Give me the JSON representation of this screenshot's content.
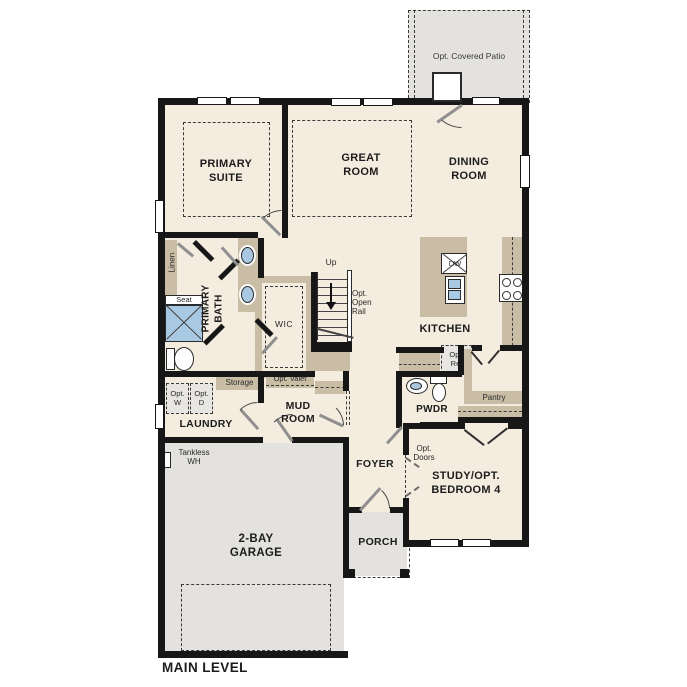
{
  "title": {
    "label": "MAIN LEVEL"
  },
  "rooms": {
    "patio": {
      "label": "Opt. Covered Patio"
    },
    "primary_suite": {
      "label": "PRIMARY\nSUITE"
    },
    "great_room": {
      "label": "GREAT\nROOM"
    },
    "dining_room": {
      "label": "DINING\nROOM"
    },
    "kitchen": {
      "label": "KITCHEN"
    },
    "primary_bath": {
      "label": "PRIMARY\nBATH"
    },
    "wic": {
      "label": "WIC"
    },
    "laundry": {
      "label": "LAUNDRY"
    },
    "mud_room": {
      "label": "MUD\nROOM"
    },
    "pwdr": {
      "label": "PWDR"
    },
    "pantry": {
      "label": "Pantry"
    },
    "foyer": {
      "label": "FOYER"
    },
    "study": {
      "label": "STUDY/OPT.\nBEDROOM 4"
    },
    "garage": {
      "label": "2-BAY\nGARAGE"
    },
    "porch": {
      "label": "PORCH"
    }
  },
  "features": {
    "linen": "Linen",
    "seat": "Seat",
    "storage": "Storage",
    "opt_valet": "Opt. Valet",
    "opt_washer": "Opt.\nW",
    "opt_dryer": "Opt.\nD",
    "opt_ref": "Opt.\nRef",
    "dishwasher": "DW",
    "stairs_up": "Up",
    "opt_open_rail": "Opt.\nOpen\nRail",
    "opt_doors": "Opt.\nDoors",
    "tankless_wh": "Tankless\nWH"
  },
  "colors": {
    "floor": "#f4ecdf",
    "exterior_zone": "#e3e2df",
    "cabinetry": "#c9bda6",
    "plumbing_fixture_blue": "#a9c9e2",
    "wall": "#171717"
  }
}
